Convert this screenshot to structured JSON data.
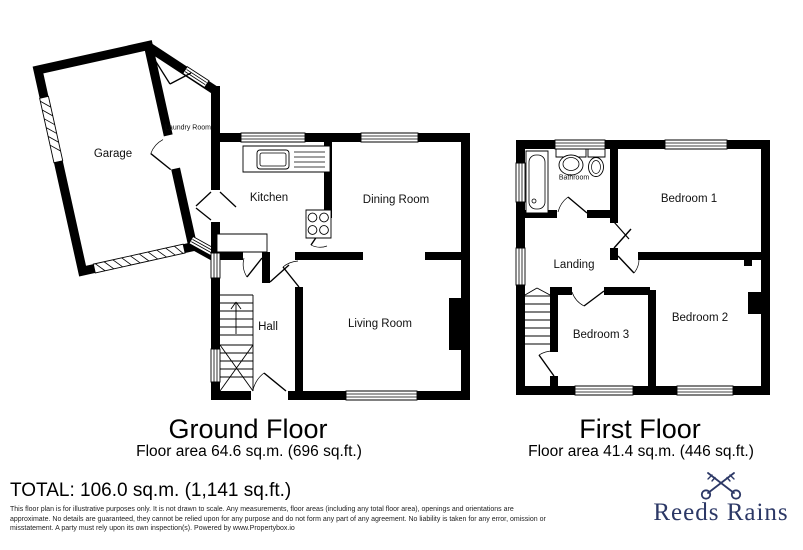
{
  "plans": {
    "ground": {
      "title": "Ground Floor",
      "area_label": "Floor area 64.6 sq.m. (696 sq.ft.)",
      "rooms": {
        "garage": "Garage",
        "laundry": "Laundry Room",
        "kitchen": "Kitchen",
        "dining": "Dining Room",
        "hall": "Hall",
        "living": "Living Room"
      }
    },
    "first": {
      "title": "First Floor",
      "area_label": "Floor area 41.4 sq.m. (446 sq.ft.)",
      "rooms": {
        "bathroom": "Bathroom",
        "bedroom1": "Bedroom 1",
        "landing": "Landing",
        "bedroom3": "Bedroom 3",
        "bedroom2": "Bedroom 2"
      }
    }
  },
  "summary": {
    "total_label": "TOTAL: 106.0 sq.m. (1,141 sq.ft.)"
  },
  "disclaimer": {
    "line1": "This floor plan is for illustrative purposes only. It is not drawn to scale. Any measurements, floor areas (including any total floor area), openings and orientations are",
    "line2": "approximate. No details are guaranteed, they cannot be relied upon for any purpose and do not form any part of any agreement. No liability is taken for any error, omission or",
    "line3": "misstatement. A party must rely upon its own inspection(s). Powered by www.Propertybox.io"
  },
  "branding": {
    "name": "Reeds Rains",
    "icon": "crossed-keys",
    "color": "#2c3866"
  },
  "colors": {
    "walls": "#000000",
    "background": "#ffffff"
  }
}
